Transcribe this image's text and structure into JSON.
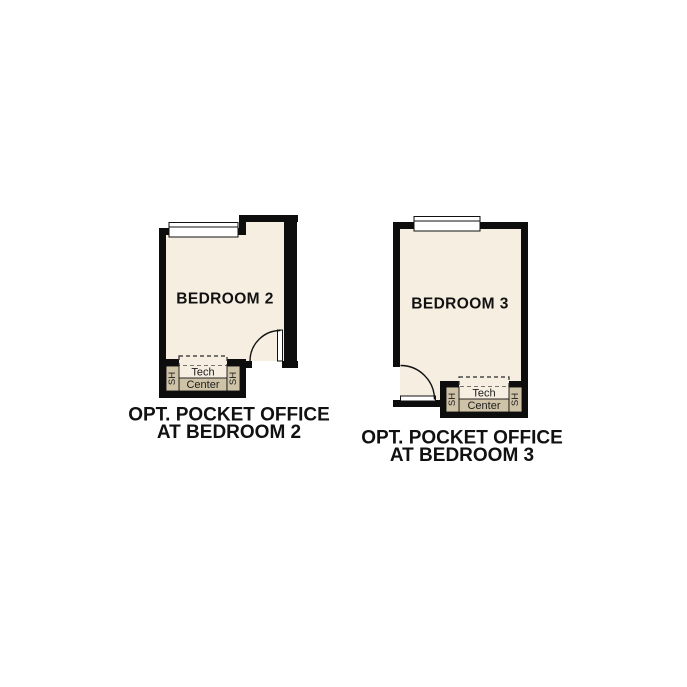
{
  "plans": [
    {
      "id": "bedroom2",
      "room_label": "BEDROOM 2",
      "tech_center": {
        "line1": "Tech",
        "line2": "Center",
        "shelf_left": "SH",
        "shelf_right": "SH"
      },
      "caption": {
        "line1": "OPT. POCKET OFFICE",
        "line2": "AT BEDROOM 2"
      }
    },
    {
      "id": "bedroom3",
      "room_label": "BEDROOM 3",
      "tech_center": {
        "line1": "Tech",
        "line2": "Center",
        "shelf_left": "SH",
        "shelf_right": "SH"
      },
      "caption": {
        "line1": "OPT. POCKET OFFICE",
        "line2": "AT BEDROOM 3"
      }
    }
  ],
  "colors": {
    "wall": "#0d0d0d",
    "floor": "#f5eee1",
    "shelf": "#cfc3a7",
    "window": "#ffffff",
    "text": "#111111"
  }
}
